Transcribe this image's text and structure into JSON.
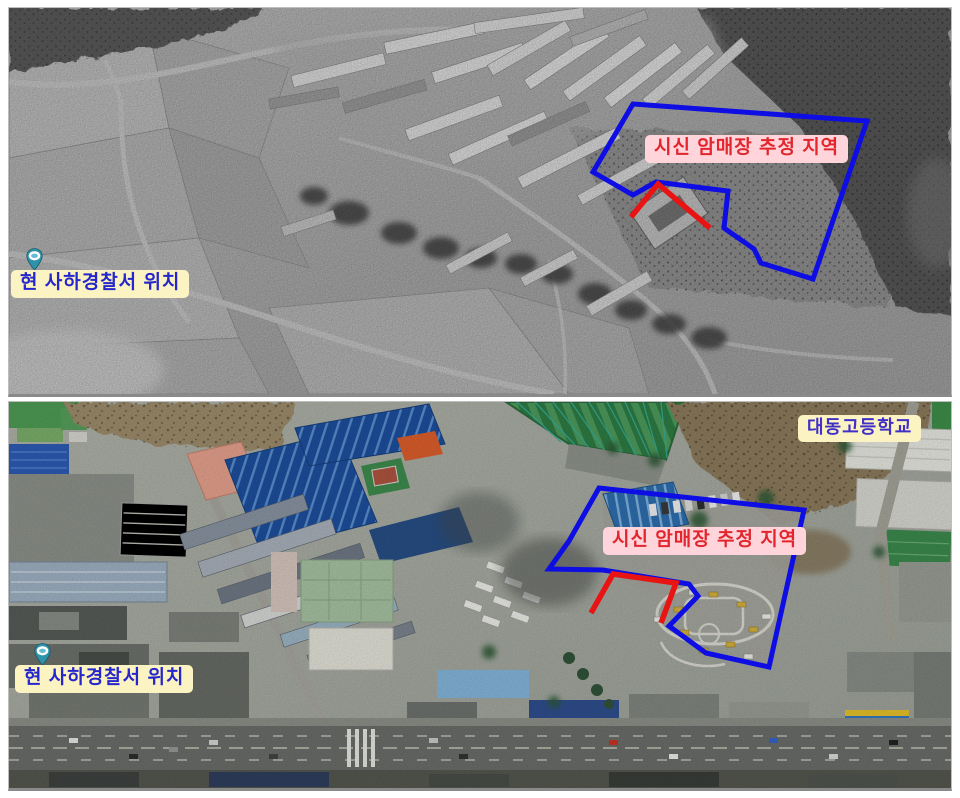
{
  "colors": {
    "area_outline": "#0d0de4",
    "area_highlight": "#e81414",
    "burial_bg": "#ffd4da",
    "burial_fg": "#e2262e",
    "info_bg": "#fcf3c2",
    "info_fg": "#2626cd",
    "school_fg": "#4030c8",
    "pin_fill": "#2f93a8"
  },
  "icons": {
    "police_location_marker": "map-pin"
  },
  "top_photo": {
    "burial_label": "시신 암매장 추정 지역",
    "police_label": "현 사하경찰서 위치"
  },
  "bottom_photo": {
    "school_label": "대동고등학교",
    "burial_label": "시신 암매장 추정 지역",
    "police_label": "현 사하경찰서 위치"
  }
}
